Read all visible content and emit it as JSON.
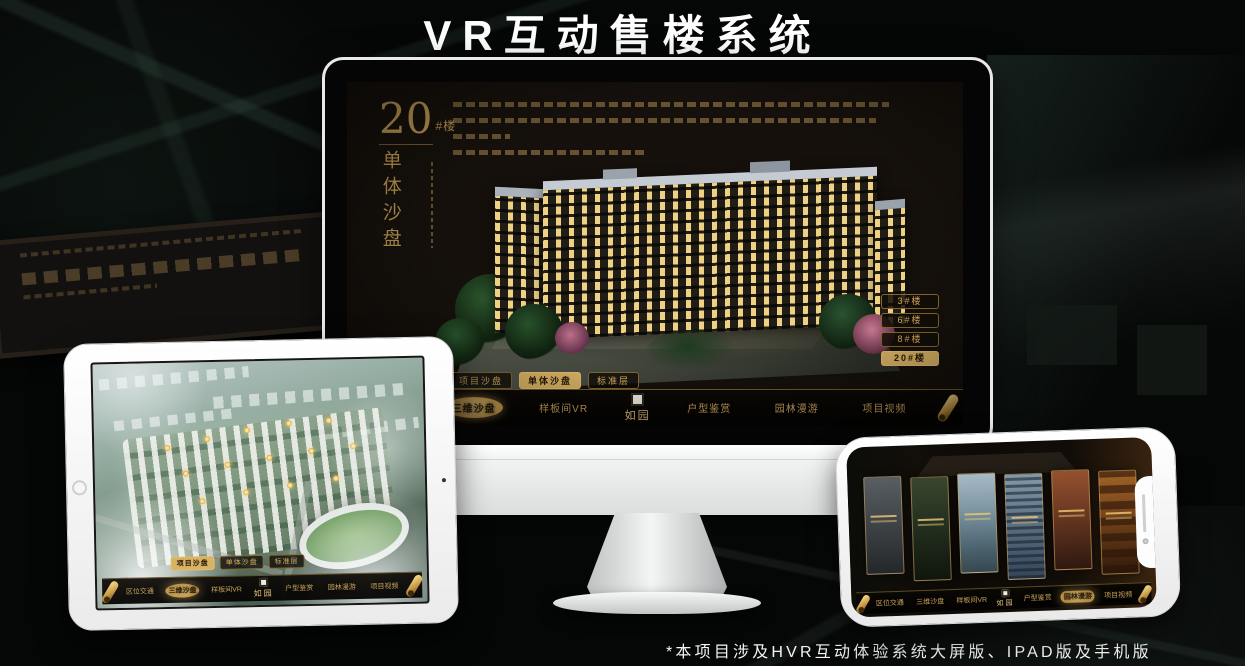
{
  "page": {
    "title": "VR互动售楼系统",
    "footnote": "*本项目涉及HVR互动体验系统大屏版、IPAD版及手机版"
  },
  "colors": {
    "gold": "#c9a35c",
    "gold_active": "#d9b264",
    "screen_bg": "#15100b"
  },
  "monitor_app": {
    "heading": {
      "number": "20",
      "suffix": "#楼",
      "subtitle_vertical": "单体沙盘"
    },
    "floor_buttons": [
      {
        "label": "3#楼",
        "active": false
      },
      {
        "label": "6#楼",
        "active": false
      },
      {
        "label": "8#楼",
        "active": false
      },
      {
        "label": "20#楼",
        "active": true
      }
    ],
    "sub_tabs": [
      {
        "label": "项目沙盘",
        "active": false
      },
      {
        "label": "单体沙盘",
        "active": true
      },
      {
        "label": "标准层",
        "active": false
      }
    ],
    "nav_items": [
      {
        "label": "区位交通",
        "active": false
      },
      {
        "label": "三维沙盘",
        "active": true
      },
      {
        "label": "样板间VR",
        "active": false
      },
      {
        "label": "户型鉴赏",
        "active": false
      },
      {
        "label": "园林漫游",
        "active": false
      },
      {
        "label": "项目视频",
        "active": false
      }
    ],
    "logo_text": "如园"
  },
  "tablet_app": {
    "sub_tabs": [
      {
        "label": "项目沙盘",
        "active": true
      },
      {
        "label": "单体沙盘",
        "active": false
      },
      {
        "label": "标准层",
        "active": false
      }
    ],
    "nav_items": [
      {
        "label": "区位交通",
        "active": false
      },
      {
        "label": "三维沙盘",
        "active": true
      },
      {
        "label": "样板间VR",
        "active": false
      },
      {
        "label": "户型鉴赏",
        "active": false
      },
      {
        "label": "园林漫游",
        "active": false
      },
      {
        "label": "项目视频",
        "active": false
      }
    ],
    "logo_text": "如园"
  },
  "phone_app": {
    "nav_items": [
      {
        "label": "区位交通",
        "active": false
      },
      {
        "label": "三维沙盘",
        "active": false
      },
      {
        "label": "样板间VR",
        "active": false
      },
      {
        "label": "户型鉴赏",
        "active": false
      },
      {
        "label": "园林漫游",
        "active": true
      },
      {
        "label": "项目视频",
        "active": false
      }
    ],
    "logo_text": "如园"
  }
}
